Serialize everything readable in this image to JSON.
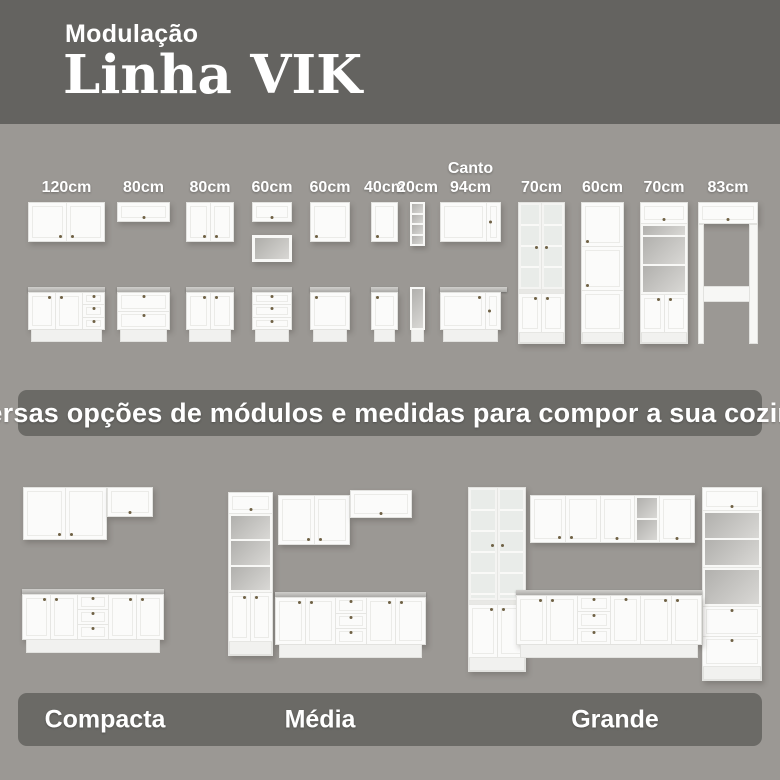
{
  "header": {
    "kicker": "Modulação",
    "title": "Linha VIK"
  },
  "modules": {
    "items": [
      {
        "label": "120cm"
      },
      {
        "label": "80cm"
      },
      {
        "label": "80cm"
      },
      {
        "label": "60cm"
      },
      {
        "label": "60cm"
      },
      {
        "label": "40cm"
      },
      {
        "label": "20cm"
      },
      {
        "label": "Canto 94cm"
      },
      {
        "label": "70cm"
      },
      {
        "label": "60cm"
      },
      {
        "label": "70cm"
      },
      {
        "label": "83cm"
      }
    ]
  },
  "banner": {
    "text": "Diversas opções de módulos e medidas para compor a sua cozinha!"
  },
  "kitchens": {
    "items": [
      {
        "name": "Compacta"
      },
      {
        "name": "Média"
      },
      {
        "name": "Grande"
      }
    ]
  },
  "colors": {
    "header_bg": "#646360",
    "body_bg": "#9b9894",
    "band_bg": "#6b6a66",
    "text": "#ffffff",
    "cabinet": "#fbfbfa",
    "countertop": "#b3b2af",
    "handle": "#6f6145"
  }
}
